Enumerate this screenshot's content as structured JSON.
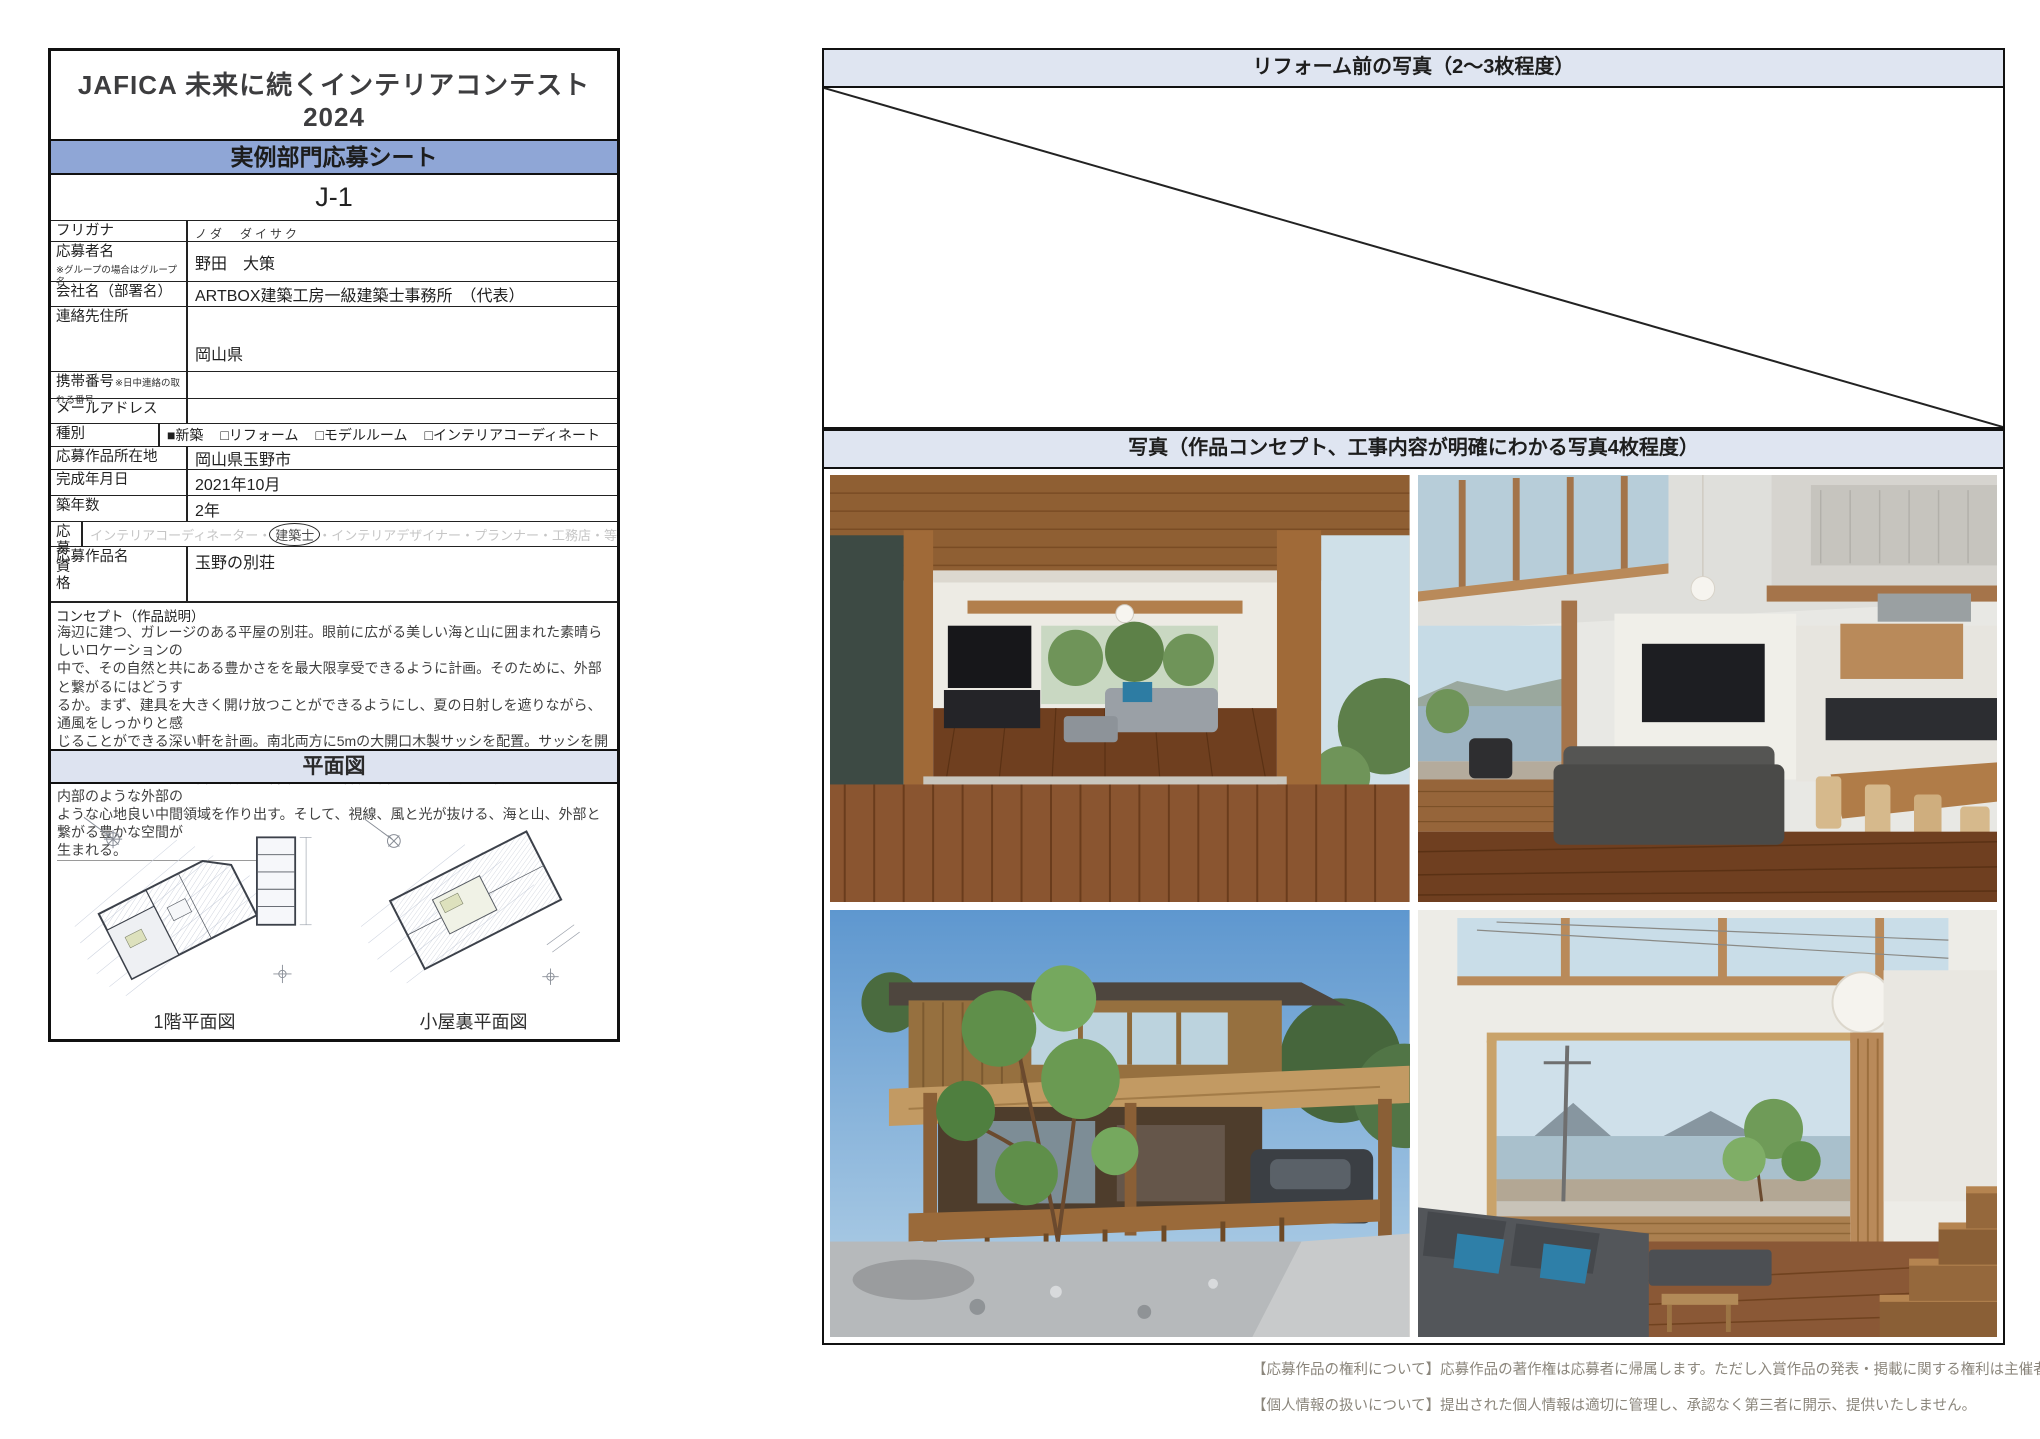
{
  "document": {
    "title": "JAFICA 未来に続くインテリアコンテスト 2024",
    "subtitle": "キズナでつながろう、共創の未来へ。",
    "sheet_type": "実例部門応募シート",
    "entry_number": "J-1"
  },
  "form": {
    "rows": [
      {
        "label": "フリガナ",
        "value": "ノダ　ダイサク"
      },
      {
        "label": "応募者名",
        "note": "※グループの場合はグループ名",
        "value": "野田　大策"
      },
      {
        "label": "会社名（部署名）",
        "value": "ARTBOX建築工房一級建築士事務所　（代表）"
      },
      {
        "label": "連絡先住所",
        "value": "岡山県"
      },
      {
        "label": "携帯番号",
        "note": "※日中連絡の取れる番号",
        "value": ""
      },
      {
        "label": "メールアドレス",
        "value": ""
      },
      {
        "label": "種別",
        "value": ""
      },
      {
        "label": "応募作品所在地",
        "value": "岡山県玉野市"
      },
      {
        "label": "完成年月日",
        "value": "2021年10月"
      },
      {
        "label": "築年数",
        "value": "2年"
      },
      {
        "label": "応募資格",
        "value": ""
      },
      {
        "label": "応募作品名",
        "value": "玉野の別荘"
      }
    ],
    "type_options": [
      "■新築",
      "□リフォーム",
      "□モデルルーム",
      "□インテリアコーディネート"
    ],
    "qualification": {
      "before": "インテリアコーディネーター・",
      "circled": "建築士",
      "after": "・インテリアデザイナー・プランナー・工務店・等"
    }
  },
  "concept": {
    "heading": "コンセプト（作品説明）",
    "lines": [
      "海辺に建つ、ガレージのある平屋の別荘。眼前に広がる美しい海と山に囲まれた素晴らしいロケーションの",
      "中で、その自然と共にある豊かさをを最大限享受できるように計画。そのために、外部と繋がるにはどうす",
      "るか。まず、建具を大きく開け放つことができるようにし、夏の日射しを遮りながら、通風をしっかりと感",
      "じることができる深い軒を計画。南北両方に5mの大開口木製サッシを配置。サッシを開け放つと、ウッド",
      "デッキへと繋がる。空間の領域を曖昧にし、外部空間、景色を美しく取り込みながら、内部のような外部の",
      "ような心地良い中間領域を作り出す。そして、視線、風と光が抜ける、海と山、外部と繋がる豊かな空間が",
      "生まれる。"
    ]
  },
  "plans": {
    "banner": "平面図",
    "captions": [
      "1階平面図",
      "小屋裏平面図"
    ]
  },
  "photos": {
    "before_banner": "リフォーム前の写真（2〜3枚程度）",
    "main_banner": "写真（作品コンセプト、工事内容が明確にわかる写真4枚程度）",
    "items": [
      {
        "alt": "wood-deck-looking-into-open-living-room"
      },
      {
        "alt": "high-ceiling-living-dining-with-sea-view"
      },
      {
        "alt": "exterior-wooden-house-garage-and-tree"
      },
      {
        "alt": "interior-sofa-with-harbor-view-and-stairs"
      }
    ]
  },
  "footer": {
    "line1": "【応募作品の権利について】応募作品の著作権は応募者に帰属します。ただし入賞作品の発表・掲載に関する権利は主催者が保有",
    "line2": "【個人情報の扱いについて】提出された個人情報は適切に管理し、承認なく第三者に開示、提供いたしません。"
  },
  "colors": {
    "banner_blue": "#8fa6d6",
    "banner_light_blue": "#dde3f0",
    "border_black": "#111111",
    "qualification_gray": "#c6c6c6",
    "footer_gray": "#8b867c"
  }
}
